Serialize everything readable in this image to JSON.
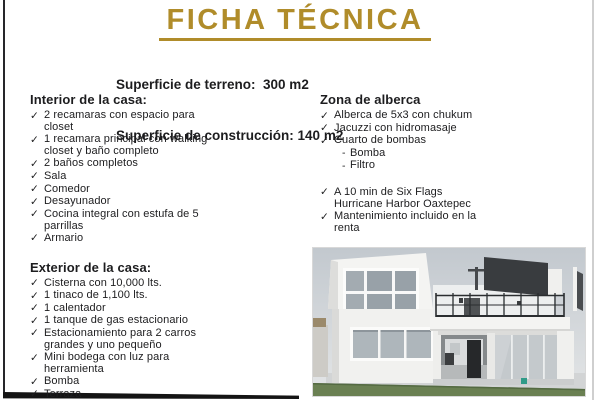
{
  "colors": {
    "accent": "#b08c2a",
    "text": "#1d1d1f"
  },
  "icons": {
    "check": "✓",
    "dash": "-"
  },
  "header": {
    "title": "FICHA TÉCNICA",
    "surface_land": "Superficie de terreno:  300 m2",
    "surface_construction": "Superficie de construcción: 140 m2"
  },
  "sections": {
    "interior": {
      "heading": "Interior de la casa:",
      "items": [
        "2 recamaras con espacio para closet",
        "1 recamara principal con walking closet y baño completo",
        "2 baños completos",
        "Sala",
        "Comedor",
        "Desayunador",
        "Cocina integral con estufa de 5 parrillas",
        "Armario"
      ]
    },
    "exterior": {
      "heading": "Exterior de la casa:",
      "items": [
        "Cisterna con 10,000 lts.",
        "1 tinaco de 1,100 lts.",
        "1 calentador",
        "1 tanque de gas estacionario",
        "Estacionamiento para 2 carros grandes y uno pequeño",
        "Mini bodega con luz para herramienta",
        "Bomba",
        "Terraza"
      ]
    },
    "alberca": {
      "heading": "Zona de alberca",
      "items": [
        "Alberca de 5x3 con chukum",
        "Jacuzzi con hidromasaje",
        "Cuarto de bombas"
      ],
      "sub_items": [
        "Bomba",
        "Filtro"
      ],
      "extra_items": [
        "A 10 min de Six Flags Hurricane Harbor Oaxtepec",
        "Mantenimiento incluido en la renta"
      ]
    }
  }
}
